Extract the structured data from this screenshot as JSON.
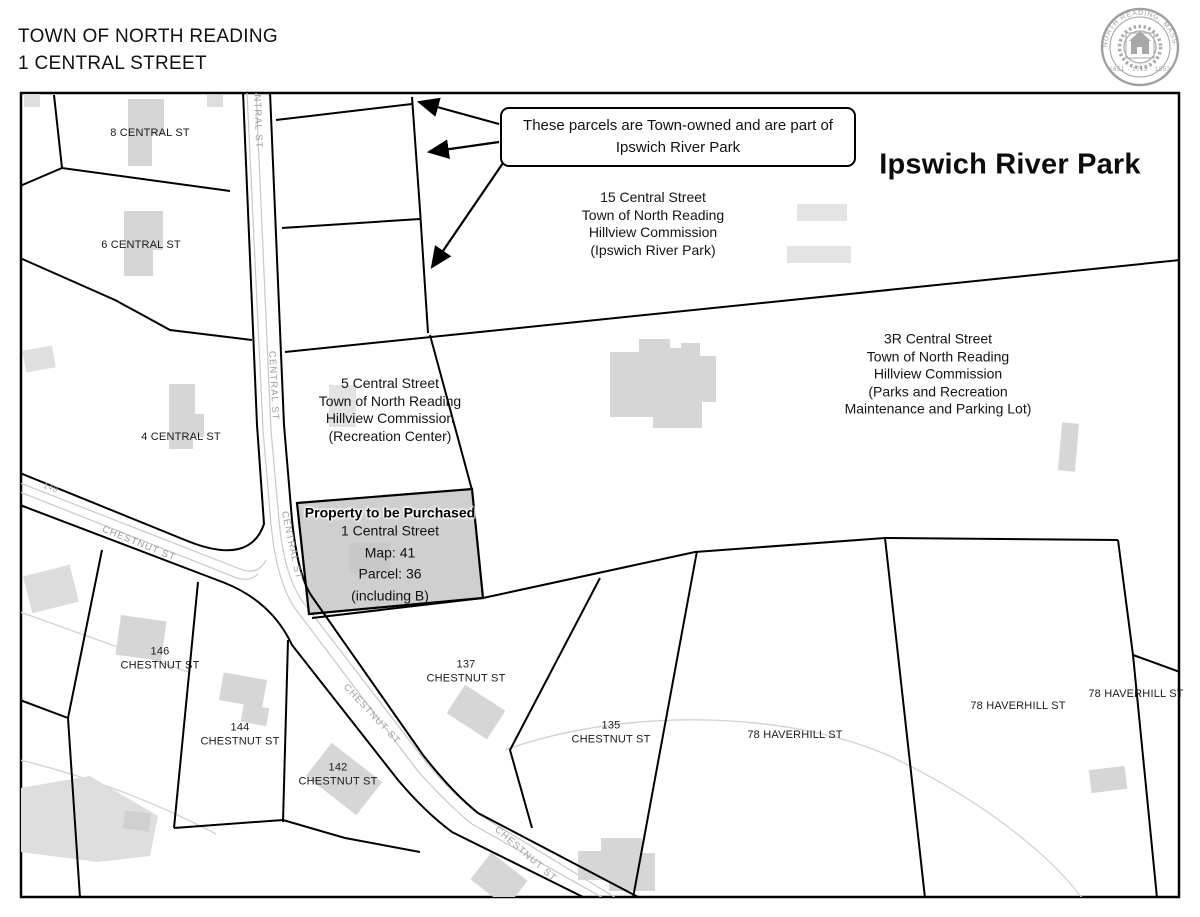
{
  "header": {
    "line1": "TOWN OF NORTH READING",
    "line2": "1 CENTRAL STREET"
  },
  "seal": {
    "ring_text": "NORTH READING, MASS.",
    "dates": "1651 · 1713 · 1853"
  },
  "map": {
    "headline": "Ipswich River Park",
    "callout": {
      "text": "These parcels are Town-owned and are part of\nIpswich River Park"
    },
    "parcel_blocks": [
      {
        "id": "15-central",
        "lines": [
          "15 Central Street",
          "Town of North Reading",
          "Hillview Commission",
          "(Ipswich River Park)"
        ]
      },
      {
        "id": "3r-central",
        "lines": [
          "3R Central Street",
          "Town of North Reading",
          "Hillview Commission",
          "(Parks and Recreation",
          "Maintenance and Parking Lot)"
        ]
      },
      {
        "id": "5-central",
        "lines": [
          "5 Central Street",
          "Town of North Reading",
          "Hillview Commission",
          "(Recreation Center)"
        ]
      }
    ],
    "purchase": {
      "title": "Property to be Purchased",
      "lines": [
        "1 Central Street",
        "Map: 41",
        "Parcel: 36",
        "(including B)"
      ]
    },
    "address_labels": [
      {
        "text": "8 CENTRAL ST"
      },
      {
        "text": "6 CENTRAL ST"
      },
      {
        "text": "4 CENTRAL ST"
      },
      {
        "text": "146\nCHESTNUT ST"
      },
      {
        "text": "144\nCHESTNUT ST"
      },
      {
        "text": "142\nCHESTNUT ST"
      },
      {
        "text": "137\nCHESTNUT ST"
      },
      {
        "text": "135\nCHESTNUT ST"
      },
      {
        "text": "78 HAVERHILL ST"
      },
      {
        "text": "78 HAVERHILL ST"
      },
      {
        "text": "78 HAVERHILL ST"
      }
    ],
    "road_labels": [
      {
        "name": "central-st-top",
        "text": "CENTRAL ST"
      },
      {
        "name": "central-st-mid",
        "text": "CENTRAL ST"
      },
      {
        "name": "central-st-lower",
        "text": "CENTRAL ST"
      },
      {
        "name": "chestnut-st-west",
        "text": "CHESTNUT ST"
      },
      {
        "name": "chestnut-st-mid",
        "text": "CHESTNUT ST"
      },
      {
        "name": "chestnut-st-south",
        "text": "CHESTNUT ST"
      },
      {
        "name": "house-number-148",
        "text": "148"
      }
    ],
    "colors": {
      "parcel_line": "#000000",
      "purchased_parcel_fill": "#cfcfcf",
      "building_fill": "#d6d6d6",
      "road_edge": "#c8c8c8",
      "seal": "#8f8f8f"
    }
  }
}
